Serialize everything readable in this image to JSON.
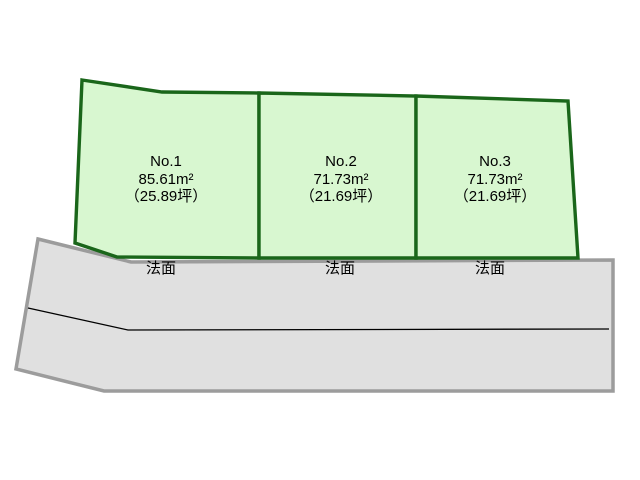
{
  "diagram": {
    "title": "land-lot-layout",
    "plots": [
      {
        "name": "No.1",
        "area_m2": "85.61m²",
        "area_tsubo": "（25.89坪）",
        "slope_label": "法面"
      },
      {
        "name": "No.2",
        "area_m2": "71.73m²",
        "area_tsubo": "（21.69坪）",
        "slope_label": "法面"
      },
      {
        "name": "No.3",
        "area_m2": "71.73m²",
        "area_tsubo": "（21.69坪）",
        "slope_label": "法面"
      }
    ],
    "colors": {
      "plot_fill": "#d8f7d0",
      "plot_border": "#1a661a",
      "road_fill": "#e0e0e0",
      "road_border": "#9c9c9c",
      "centerline": "#000000",
      "background": "#ffffff",
      "text": "#000000"
    }
  }
}
